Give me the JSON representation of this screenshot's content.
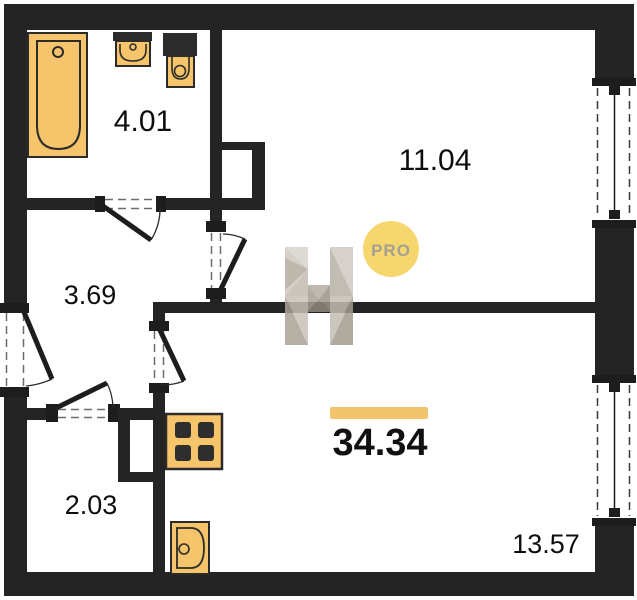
{
  "plan": {
    "title": "apartment-floor-plan",
    "total_area": "34.34",
    "rooms": [
      {
        "id": "bathroom",
        "area": "4.01"
      },
      {
        "id": "bedroom",
        "area": "11.04"
      },
      {
        "id": "hallway",
        "area": "3.69"
      },
      {
        "id": "closet",
        "area": "2.03"
      },
      {
        "id": "living-kitchen",
        "area": "13.57"
      }
    ],
    "fixtures": [
      "bathtub-icon",
      "washbasin-icon",
      "toilet-icon",
      "stove-icon",
      "kitchen-sink-icon"
    ],
    "windows": 2,
    "doors": 5
  },
  "brand": {
    "badge": "PRO",
    "logo_letter": "H"
  },
  "colors": {
    "wall": "#242424",
    "fixture_fill": "#F5C46B",
    "fixture_stroke": "#2b2b2b",
    "badge_bg": "#F6D76E",
    "badge_text": "#A59E94",
    "accent_bar": "#F2C46D"
  }
}
